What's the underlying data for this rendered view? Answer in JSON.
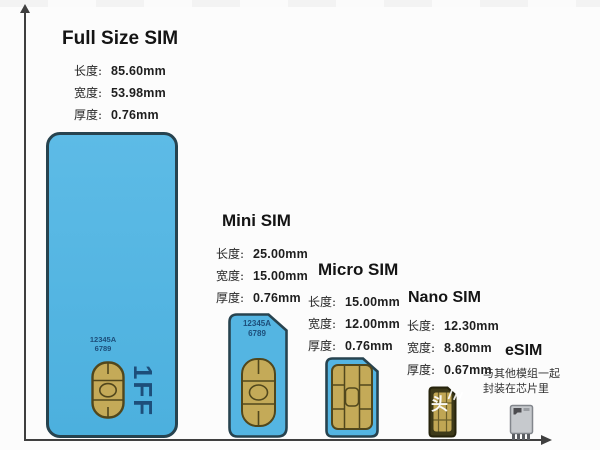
{
  "colors": {
    "card_blue": "#54b5e2",
    "card_border": "#27434f",
    "chip_gold": "#c4aa58",
    "chip_line": "#51471c",
    "card_text": "#1d4e7a",
    "axis": "#3f3f3f",
    "nano_body": "#3e3a19",
    "esim_body": "#c6c9cd"
  },
  "watermark": {
    "text": "头"
  },
  "cards": [
    {
      "title": "Full Size SIM",
      "specs": [
        {
          "label": "长度:",
          "value": "85.60mm"
        },
        {
          "label": "宽度:",
          "value": "53.98mm"
        },
        {
          "label": "厚度:",
          "value": "0.76mm"
        }
      ],
      "number_line1": "12345A",
      "number_line2": "6789",
      "form_factor": "1FF"
    },
    {
      "title": "Mini SIM",
      "specs": [
        {
          "label": "长度:",
          "value": "25.00mm"
        },
        {
          "label": "宽度:",
          "value": "15.00mm"
        },
        {
          "label": "厚度:",
          "value": "0.76mm"
        }
      ],
      "number_line1": "12345A",
      "number_line2": "6789"
    },
    {
      "title": "Micro SIM",
      "specs": [
        {
          "label": "长度:",
          "value": "15.00mm"
        },
        {
          "label": "宽度:",
          "value": "12.00mm"
        },
        {
          "label": "厚度:",
          "value": "0.76mm"
        }
      ]
    },
    {
      "title": "Nano SIM",
      "specs": [
        {
          "label": "长度:",
          "value": "12.30mm"
        },
        {
          "label": "宽度:",
          "value": "8.80mm"
        },
        {
          "label": "厚度:",
          "value": "0.67mm"
        }
      ]
    },
    {
      "title": "eSIM",
      "note_line1": "与其他模组一起",
      "note_line2": "封装在芯片里"
    }
  ]
}
